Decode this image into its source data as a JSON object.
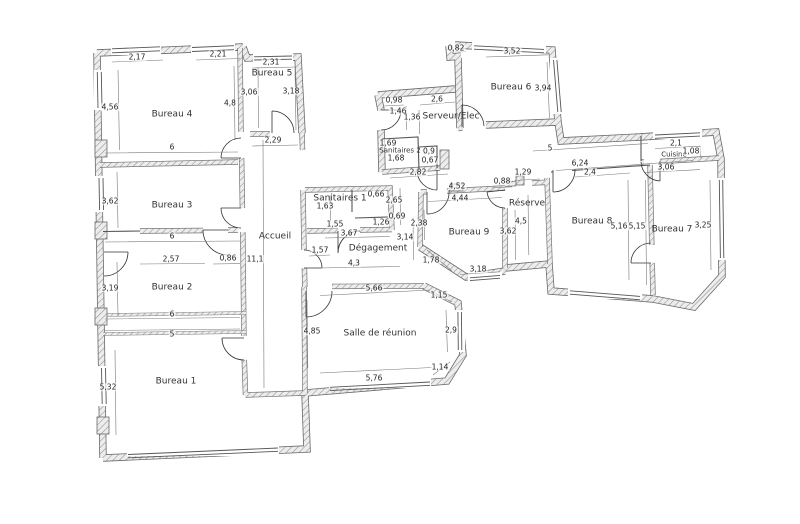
{
  "plan": {
    "background": "#ffffff",
    "wall_hatch_color": "#8f8f8f",
    "line_color": "#555555",
    "dim_text_color": "#222222",
    "rooms": [
      {
        "label": "Bureau 4",
        "x": 172,
        "y": 115
      },
      {
        "label": "Bureau 5",
        "x": 272,
        "y": 74
      },
      {
        "label": "Bureau 3",
        "x": 172,
        "y": 206
      },
      {
        "label": "Bureau 2",
        "x": 172,
        "y": 288
      },
      {
        "label": "Bureau 1",
        "x": 176,
        "y": 382
      },
      {
        "label": "Accueil",
        "x": 275,
        "y": 237
      },
      {
        "label": "Sanitaires 1",
        "x": 340,
        "y": 199
      },
      {
        "label": "Sanitaires 2",
        "x": 400,
        "y": 151,
        "small": true
      },
      {
        "label": "Serveur/Elec",
        "x": 451,
        "y": 117
      },
      {
        "label": "Dégagement",
        "x": 378,
        "y": 249
      },
      {
        "label": "Salle de réunion",
        "x": 380,
        "y": 334
      },
      {
        "label": "Bureau 6",
        "x": 511,
        "y": 88
      },
      {
        "label": "Cuisine",
        "x": 674,
        "y": 155,
        "small": true
      },
      {
        "label": "Réserve",
        "x": 527,
        "y": 204
      },
      {
        "label": "Bureau 9",
        "x": 469,
        "y": 233
      },
      {
        "label": "Bureau 8",
        "x": 592,
        "y": 222
      },
      {
        "label": "Bureau 7",
        "x": 672,
        "y": 230
      }
    ],
    "dimensions": [
      {
        "v": "2,17",
        "x": 137,
        "y": 57
      },
      {
        "v": "2,21",
        "x": 218,
        "y": 54
      },
      {
        "v": "2,31",
        "x": 271,
        "y": 62
      },
      {
        "v": "4,56",
        "x": 110,
        "y": 107
      },
      {
        "v": "4,8",
        "x": 230,
        "y": 103
      },
      {
        "v": "3,06",
        "x": 249,
        "y": 92
      },
      {
        "v": "3,18",
        "x": 291,
        "y": 91
      },
      {
        "v": "2,29",
        "x": 273,
        "y": 140
      },
      {
        "v": "6",
        "x": 172,
        "y": 147
      },
      {
        "v": "3,62",
        "x": 110,
        "y": 201
      },
      {
        "v": "6",
        "x": 172,
        "y": 236
      },
      {
        "v": "2,57",
        "x": 171,
        "y": 259
      },
      {
        "v": "0,86",
        "x": 228,
        "y": 258
      },
      {
        "v": "11,1",
        "x": 255,
        "y": 259
      },
      {
        "v": "3,19",
        "x": 110,
        "y": 288
      },
      {
        "v": "6",
        "x": 172,
        "y": 314
      },
      {
        "v": "5",
        "x": 172,
        "y": 334
      },
      {
        "v": "5,32",
        "x": 108,
        "y": 387
      },
      {
        "v": "1,57",
        "x": 320,
        "y": 250
      },
      {
        "v": "4,85",
        "x": 312,
        "y": 331
      },
      {
        "v": "1,63",
        "x": 325,
        "y": 206
      },
      {
        "v": "0,66",
        "x": 376,
        "y": 194
      },
      {
        "v": "2,65",
        "x": 394,
        "y": 200
      },
      {
        "v": "0,69",
        "x": 397,
        "y": 216
      },
      {
        "v": "1,26",
        "x": 381,
        "y": 222
      },
      {
        "v": "1,55",
        "x": 335,
        "y": 224
      },
      {
        "v": "3,67",
        "x": 349,
        "y": 233
      },
      {
        "v": "3,14",
        "x": 405,
        "y": 237
      },
      {
        "v": "4,3",
        "x": 354,
        "y": 263
      },
      {
        "v": "2,38",
        "x": 419,
        "y": 223
      },
      {
        "v": "1,78",
        "x": 431,
        "y": 260
      },
      {
        "v": "5,66",
        "x": 374,
        "y": 288
      },
      {
        "v": "1,15",
        "x": 439,
        "y": 295
      },
      {
        "v": "2,9",
        "x": 451,
        "y": 330
      },
      {
        "v": "1,14",
        "x": 440,
        "y": 367
      },
      {
        "v": "5,76",
        "x": 374,
        "y": 378
      },
      {
        "v": "0,98",
        "x": 394,
        "y": 100
      },
      {
        "v": "1,46",
        "x": 398,
        "y": 111
      },
      {
        "v": "1,36",
        "x": 412,
        "y": 117
      },
      {
        "v": "2,6",
        "x": 437,
        "y": 99
      },
      {
        "v": "1,69",
        "x": 388,
        "y": 143
      },
      {
        "v": "1,68",
        "x": 396,
        "y": 158
      },
      {
        "v": "0,9",
        "x": 429,
        "y": 151
      },
      {
        "v": "0,67",
        "x": 430,
        "y": 160
      },
      {
        "v": "2,82",
        "x": 418,
        "y": 172
      },
      {
        "v": "0,82",
        "x": 456,
        "y": 48
      },
      {
        "v": "3,52",
        "x": 512,
        "y": 51
      },
      {
        "v": "3,94",
        "x": 543,
        "y": 88
      },
      {
        "v": "5",
        "x": 550,
        "y": 148
      },
      {
        "v": "0,88",
        "x": 502,
        "y": 181
      },
      {
        "v": "1,29",
        "x": 523,
        "y": 172
      },
      {
        "v": "4,52",
        "x": 457,
        "y": 186
      },
      {
        "v": "4,44",
        "x": 460,
        "y": 198
      },
      {
        "v": "3,18",
        "x": 478,
        "y": 269
      },
      {
        "v": "2,1",
        "x": 676,
        "y": 143
      },
      {
        "v": "1,08",
        "x": 691,
        "y": 151
      },
      {
        "v": "3,06",
        "x": 666,
        "y": 167
      },
      {
        "v": "6,24",
        "x": 580,
        "y": 163
      },
      {
        "v": "2,4",
        "x": 590,
        "y": 172
      },
      {
        "v": "5,16",
        "x": 619,
        "y": 226
      },
      {
        "v": "5,15",
        "x": 637,
        "y": 226
      },
      {
        "v": "3,25",
        "x": 703,
        "y": 225
      },
      {
        "v": "4,5",
        "x": 521,
        "y": 221
      },
      {
        "v": "3,62",
        "x": 508,
        "y": 231
      }
    ]
  }
}
